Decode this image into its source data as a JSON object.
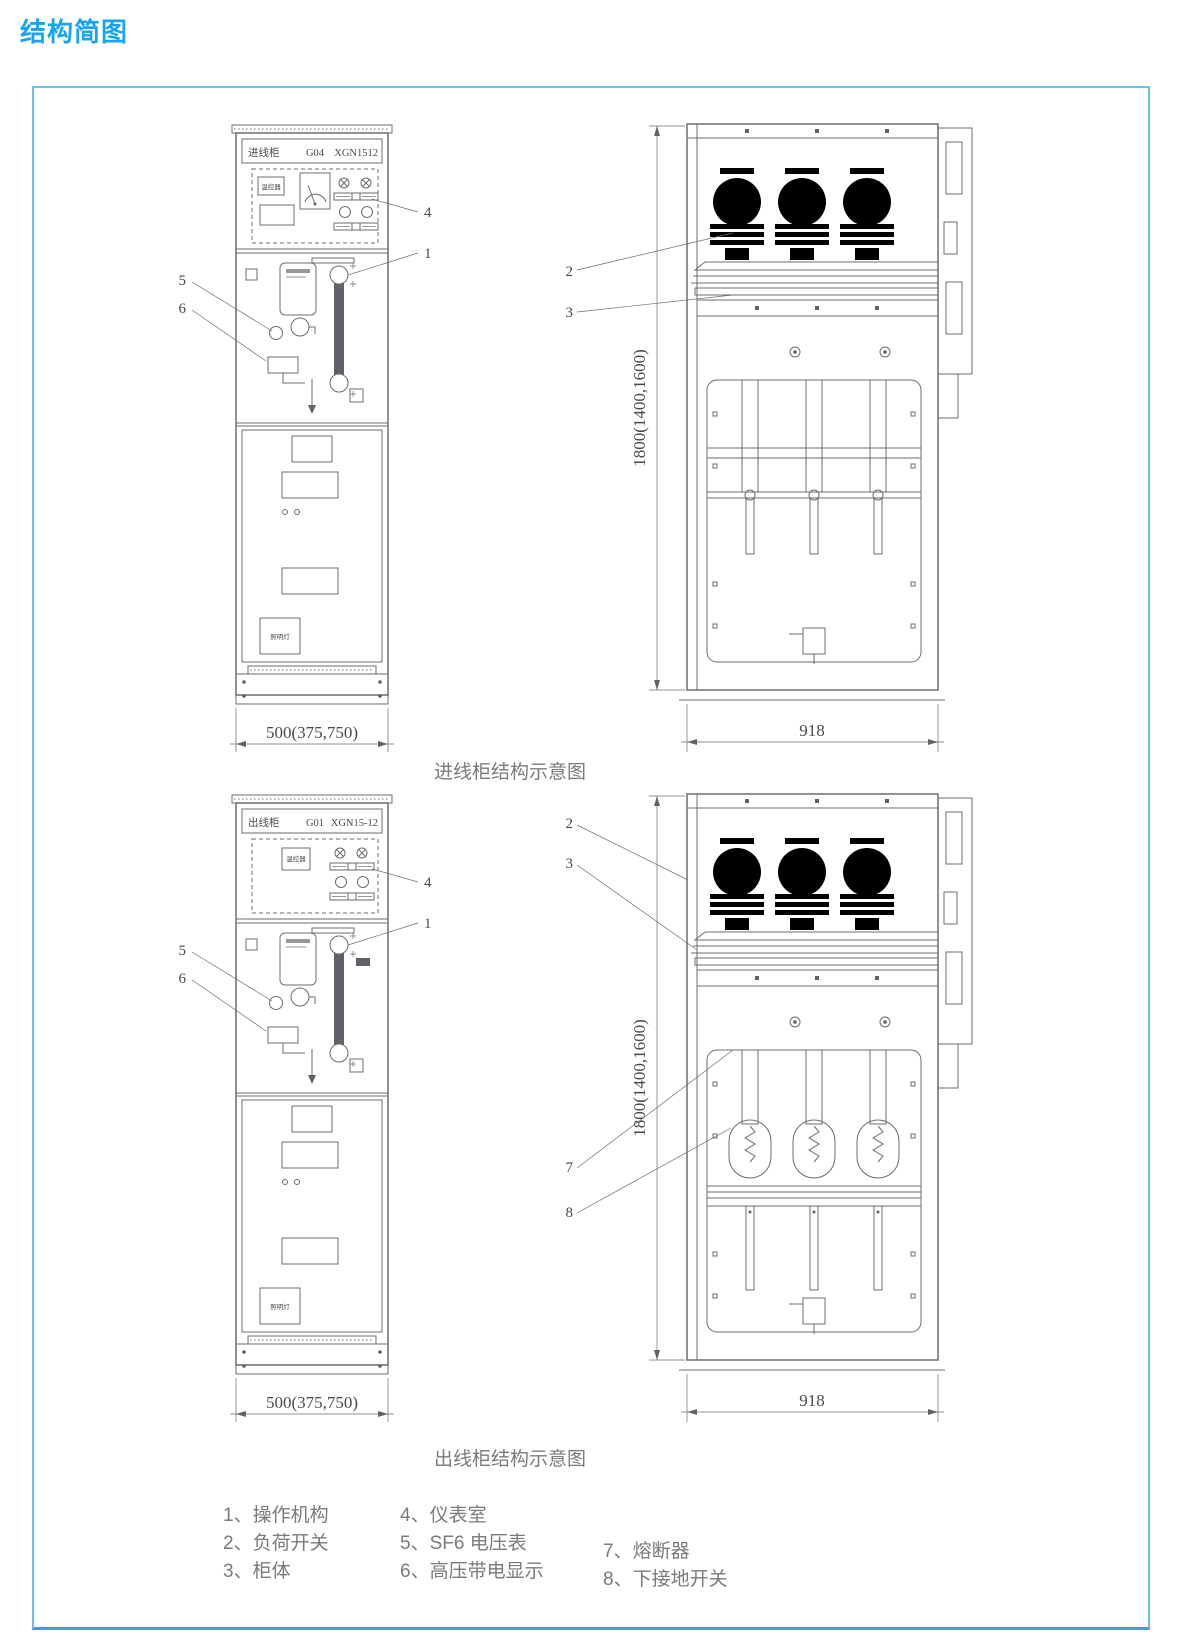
{
  "title": "结构简图",
  "figures": [
    {
      "caption": "进线柜结构示意图",
      "front": {
        "name_label": "进线柜",
        "unit_no": "G04",
        "model": "XGN1512",
        "thermostat": "温控器",
        "lamp_box": "照明灯",
        "width_dim": "500(375,750)"
      },
      "side": {
        "height_dim": "1800(1400,1600)",
        "depth_dim": "918"
      },
      "callouts": {
        "n1": "1",
        "n2": "2",
        "n3": "3",
        "n4": "4",
        "n5": "5",
        "n6": "6"
      }
    },
    {
      "caption": "出线柜结构示意图",
      "front": {
        "name_label": "出线柜",
        "unit_no": "G01",
        "model": "XGN15-12",
        "thermostat": "温控器",
        "lamp_box": "照明灯",
        "width_dim": "500(375,750)"
      },
      "side": {
        "height_dim": "1800(1400,1600)",
        "depth_dim": "918"
      },
      "callouts": {
        "n1": "1",
        "n2": "2",
        "n3": "3",
        "n4": "4",
        "n5": "5",
        "n6": "6",
        "n7": "7",
        "n8": "8"
      }
    }
  ],
  "legend": {
    "items": [
      "1、操作机构",
      "2、负荷开关",
      "3、柜体",
      "4、仪表室",
      "5、SF6 电压表",
      "6、高压带电显示",
      "7、熔断器",
      "8、下接地开关"
    ]
  },
  "colors": {
    "accent": "#18a5f0",
    "panel_border": "#63c4ea",
    "panel_border_bottom": "#29a9e1",
    "drawing_line": "#6a6d70",
    "text_gray": "#7b7b7b"
  }
}
